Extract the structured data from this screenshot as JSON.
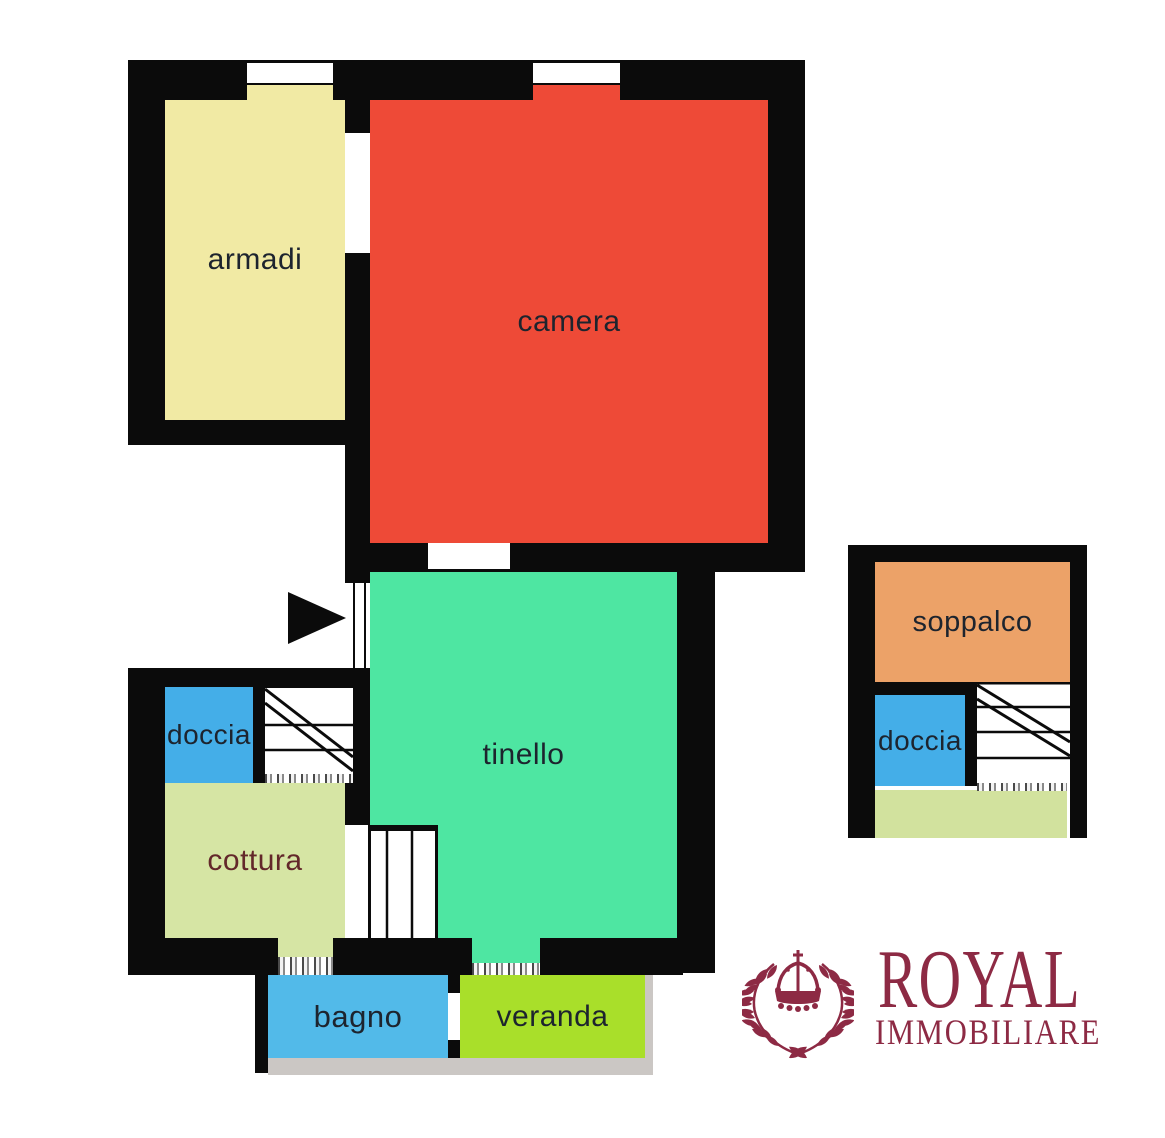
{
  "plan": {
    "type": "apartment floor plan",
    "wall_color": "#0b0b0b",
    "label_color": "#1d242e",
    "rooms": {
      "armadi": {
        "label": "armadi",
        "color": "#f1eaa4"
      },
      "camera": {
        "label": "camera",
        "color": "#ee4a37"
      },
      "tinello": {
        "label": "tinello",
        "color": "#4ee6a2"
      },
      "doccia_left": {
        "label": "doccia",
        "color": "#44aee8"
      },
      "cottura": {
        "label": "cottura",
        "color": "#d6e5a4",
        "label_color": "#63282a"
      },
      "bagno": {
        "label": "bagno",
        "color": "#52bae9"
      },
      "veranda": {
        "label": "veranda",
        "color": "#a9df2a"
      },
      "soppalco": {
        "label": "soppalco",
        "color": "#eca268"
      },
      "doccia_right": {
        "label": "doccia",
        "color": "#44aee8"
      },
      "terrace_right": {
        "color": "#d2e29e"
      }
    },
    "icons": {
      "entrance_arrow": "black right-pointing triangle",
      "stairs": "stair treads with double diagonal run lines"
    }
  },
  "logo": {
    "title": "ROYAL",
    "subtitle": "IMMOBILIARE",
    "color": "#8d2a44",
    "emblem": "laurel wreath with crown"
  }
}
